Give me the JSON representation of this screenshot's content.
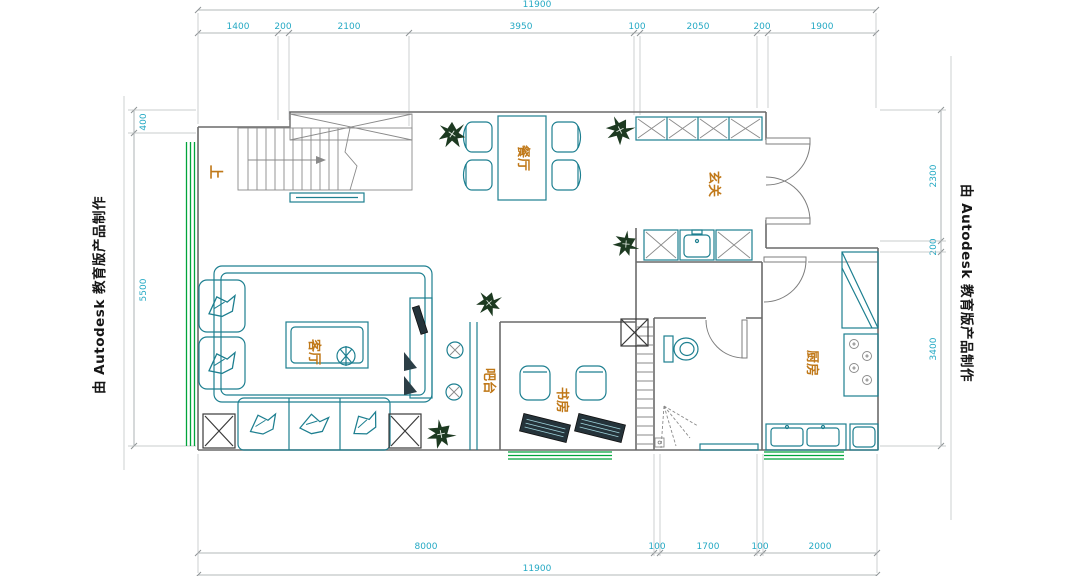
{
  "watermarks": {
    "left": "由 Autodesk 教育版产品制作",
    "right": "由 Autodesk 教育版产品制作"
  },
  "rooms": {
    "dining": "餐厅",
    "entry": "玄关",
    "living": "客厅",
    "bar": "吧台",
    "study": "书房",
    "kitchen": "厨房"
  },
  "annotations": {
    "stairs_up": "上"
  },
  "dimensions": {
    "top_total": "11900",
    "top": [
      "1400",
      "200",
      "2100",
      "3950",
      "100",
      "2050",
      "200",
      "1900"
    ],
    "bottom": [
      "8000",
      "100",
      "1700",
      "100",
      "2000"
    ],
    "bottom_total": "11900",
    "left": [
      "400",
      "5500"
    ],
    "right": [
      "2300",
      "200",
      "3400"
    ]
  },
  "colors": {
    "dimension_text": "#25a9c4",
    "furniture": "#1d7f90",
    "room_label": "#c07818",
    "window": "#00a43b",
    "walls": "#6a6a6a",
    "plant": "#1d3a21"
  }
}
